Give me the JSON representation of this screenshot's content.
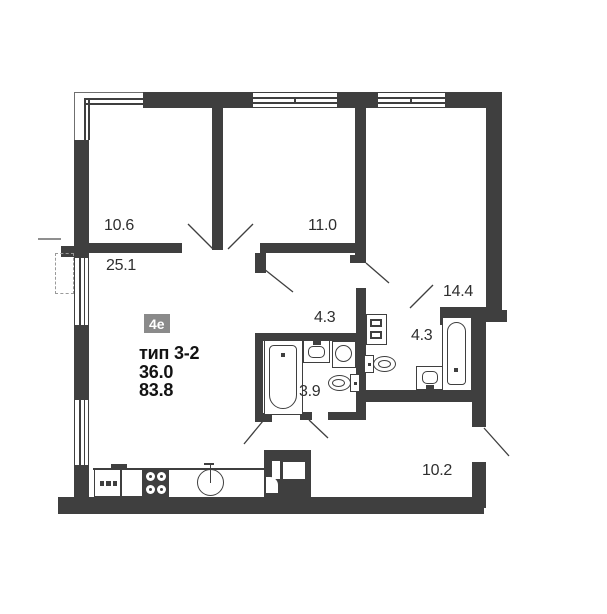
{
  "floorplan": {
    "unit_badge": "4е",
    "unit_type": "тип 3-2",
    "area_living": "36.0",
    "area_total": "83.8",
    "rooms": {
      "bedroom_small": "10.6",
      "living_kitchen": "25.1",
      "bedroom_mid": "11.0",
      "bedroom_large": "14.4",
      "hallway": "4.3",
      "bathroom_right": "4.3",
      "bathroom_main": "3.9",
      "corridor": "10.2"
    },
    "fixture_icons": [
      "bathtub-icon",
      "sink-icon",
      "washing-machine-icon",
      "toilet-icon",
      "stove-icon",
      "kitchen-sink-icon",
      "wardrobe-icon",
      "ventilation-shaft-icon",
      "window-icon",
      "door-swing-icon"
    ],
    "colors": {
      "wall": "#3f3f3f",
      "badge_bg": "#8a8a8a",
      "badge_text": "#ffffff",
      "room_label": "#2f2f2f",
      "bold_label": "#131313"
    }
  }
}
